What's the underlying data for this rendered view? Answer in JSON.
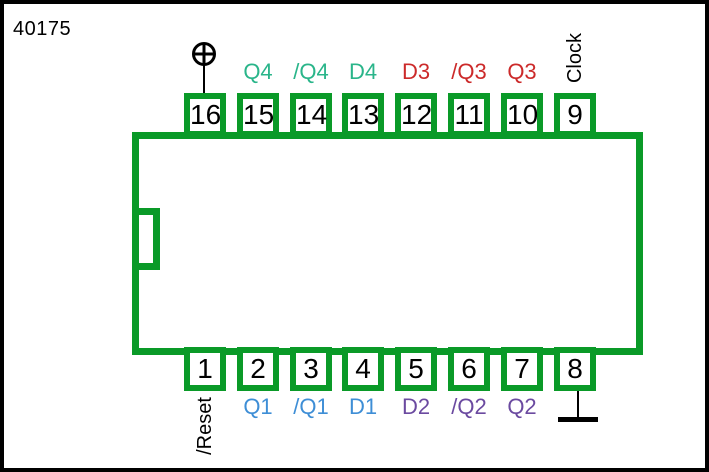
{
  "title": "40175",
  "colors": {
    "chip_green": "#0a9a28",
    "teal": "#2ab58a",
    "red": "#cc2a2a",
    "blue": "#3e8ed6",
    "purple": "#6b4aa0",
    "wire_black": "#000000"
  },
  "pins": {
    "top": [
      {
        "number": "16",
        "label": "",
        "signal": "power"
      },
      {
        "number": "15",
        "label": "Q4",
        "color": "teal"
      },
      {
        "number": "14",
        "label": "/Q4",
        "color": "teal"
      },
      {
        "number": "13",
        "label": "D4",
        "color": "teal"
      },
      {
        "number": "12",
        "label": "D3",
        "color": "red"
      },
      {
        "number": "11",
        "label": "/Q3",
        "color": "red"
      },
      {
        "number": "10",
        "label": "Q3",
        "color": "red"
      },
      {
        "number": "9",
        "label": "Clock",
        "color": "black",
        "orientation": "vertical"
      }
    ],
    "bottom": [
      {
        "number": "1",
        "label": "/Reset",
        "color": "black",
        "orientation": "vertical"
      },
      {
        "number": "2",
        "label": "Q1",
        "color": "blue"
      },
      {
        "number": "3",
        "label": "/Q1",
        "color": "blue"
      },
      {
        "number": "4",
        "label": "D1",
        "color": "blue"
      },
      {
        "number": "5",
        "label": "D2",
        "color": "purple"
      },
      {
        "number": "6",
        "label": "/Q2",
        "color": "purple"
      },
      {
        "number": "7",
        "label": "Q2",
        "color": "purple"
      },
      {
        "number": "8",
        "label": "",
        "signal": "ground"
      }
    ]
  },
  "icons": {
    "power": "circle-plus",
    "ground": "ground-bar"
  }
}
